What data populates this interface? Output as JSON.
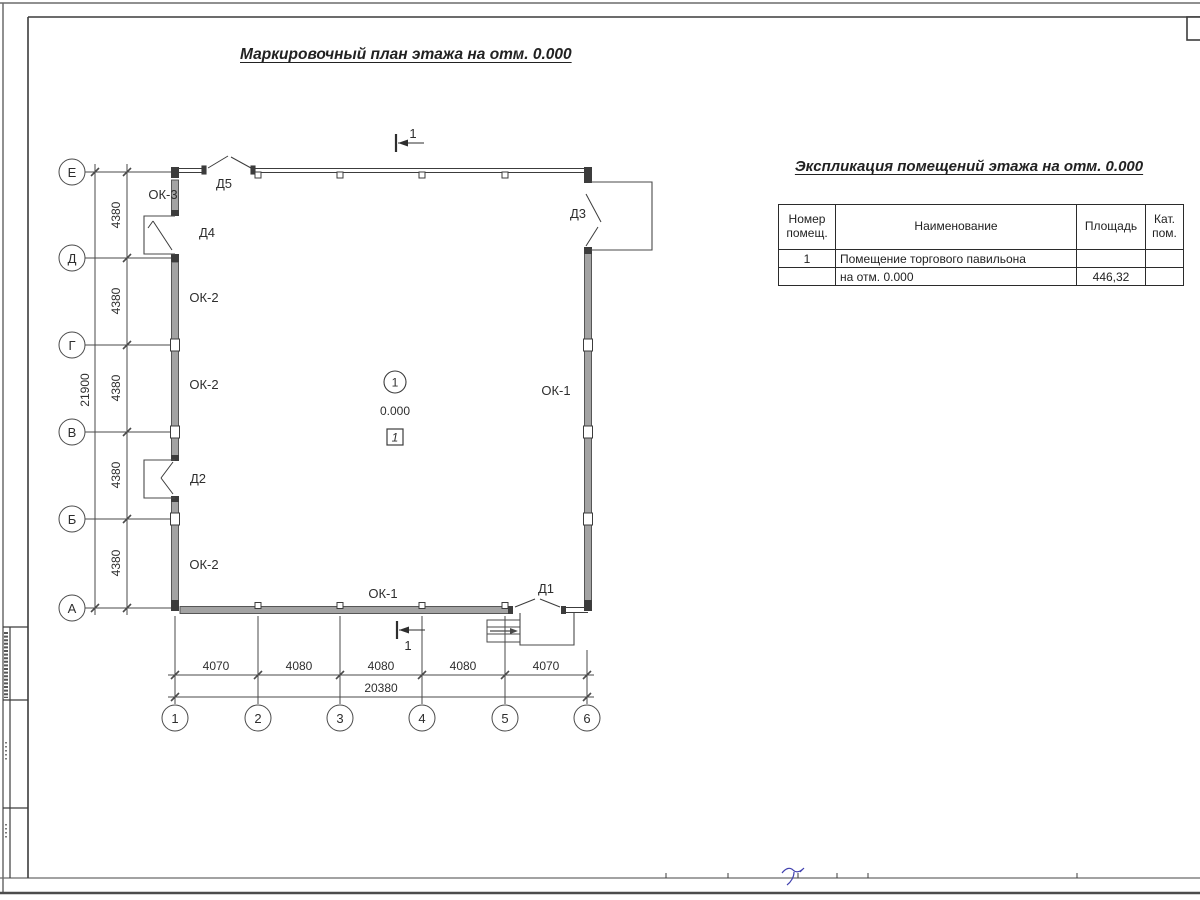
{
  "palette": {
    "line": "#3c3c3c",
    "wall_gray": "#a3a3a3",
    "accent_blue": "#4040ae"
  },
  "titles": {
    "plan": "Маркировочный план этажа на отм. 0.000",
    "table": "Экспликация помещений этажа на отм. 0.000"
  },
  "axes": {
    "rows": [
      "Е",
      "Д",
      "Г",
      "В",
      "Б",
      "А"
    ],
    "cols": [
      "1",
      "2",
      "3",
      "4",
      "5",
      "6"
    ]
  },
  "dims": {
    "left_segments": [
      "4380",
      "4380",
      "4380",
      "4380",
      "4380"
    ],
    "left_total": "21900",
    "bottom_segments": [
      "4070",
      "4080",
      "4080",
      "4080",
      "4070"
    ],
    "bottom_total": "20380"
  },
  "plan": {
    "windows": {
      "ok1": "ОК-1",
      "ok2": "ОК-2",
      "ok3": "ОК-3"
    },
    "doors": {
      "d1": "Д1",
      "d2": "Д2",
      "d3": "Д3",
      "d4": "Д4",
      "d5": "Д5"
    },
    "room": {
      "number": "1",
      "level": "0.000",
      "zone": "1"
    },
    "section_mark": "1"
  },
  "table": {
    "headers": {
      "col1": [
        "Номер",
        "помещ."
      ],
      "col2": "Наименование",
      "col3": "Площадь",
      "col4": [
        "Кат.",
        "пом."
      ]
    },
    "rows": [
      [
        "1",
        "Помещение торгового павильона",
        "",
        ""
      ],
      [
        "",
        "на отм. 0.000",
        "446,32",
        ""
      ]
    ]
  }
}
